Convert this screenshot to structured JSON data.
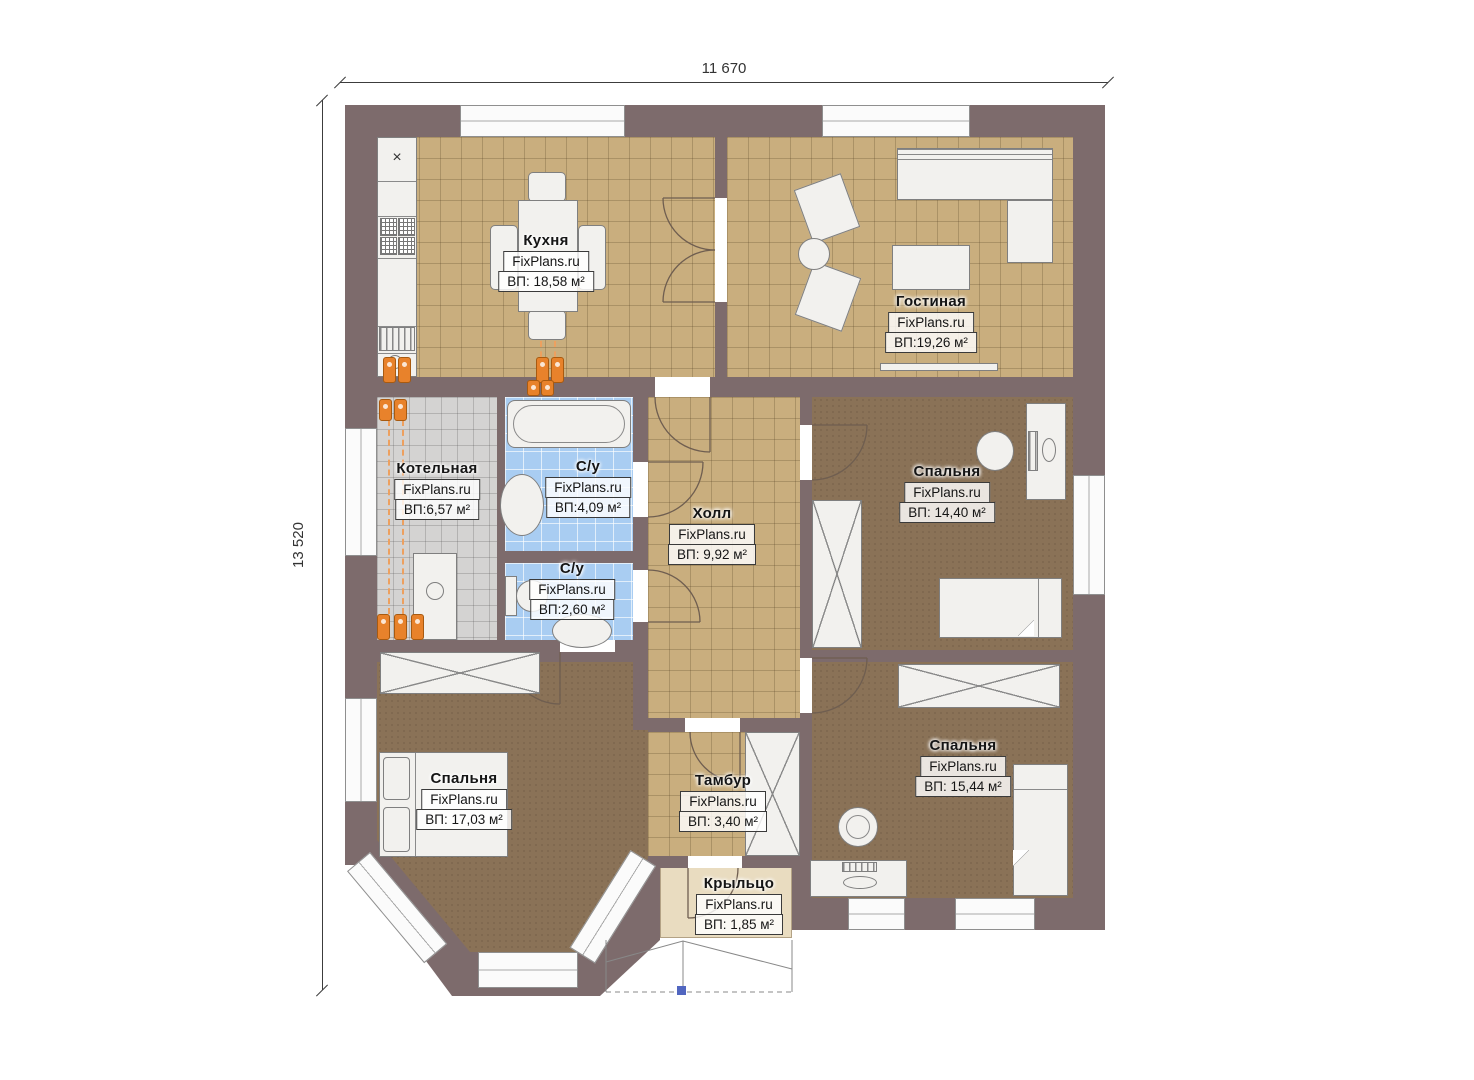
{
  "watermark": "FixPlans.ru",
  "dimensions": {
    "top": "11 670",
    "left": "13 520"
  },
  "rooms": [
    {
      "name": "Кухня",
      "area": "ВП: 18,58 м²"
    },
    {
      "name": "Гостиная",
      "area": "ВП:19,26 м²"
    },
    {
      "name": "Котельная",
      "area": "ВП:6,57 м²"
    },
    {
      "name": "С/у",
      "area": "ВП:4,09 м²"
    },
    {
      "name": "С/у",
      "area": "ВП:2,60 м²"
    },
    {
      "name": "Холл",
      "area": "ВП: 9,92 м²"
    },
    {
      "name": "Спальня",
      "area": "ВП: 14,40 м²"
    },
    {
      "name": "Спальня",
      "area": "ВП: 17,03 м²"
    },
    {
      "name": "Спальня",
      "area": "ВП: 15,44 м²"
    },
    {
      "name": "Тамбур",
      "area": "ВП: 3,40 м²"
    },
    {
      "name": "Крыльцо",
      "area": "ВП: 1,85 м²"
    }
  ],
  "symbols": {
    "kitchen_vent": "×"
  },
  "colors": {
    "wall": "#7d6b6c",
    "tile_tan": "#c9ae7e",
    "tile_gray": "#d4d3d2",
    "tile_blue": "#a9cdf2",
    "carpet": "#8a7257",
    "furniture": "#f2f1ee",
    "radiator": "#e8822b",
    "porch": "#e9dcc0",
    "entry_marker": "#5166c0"
  }
}
